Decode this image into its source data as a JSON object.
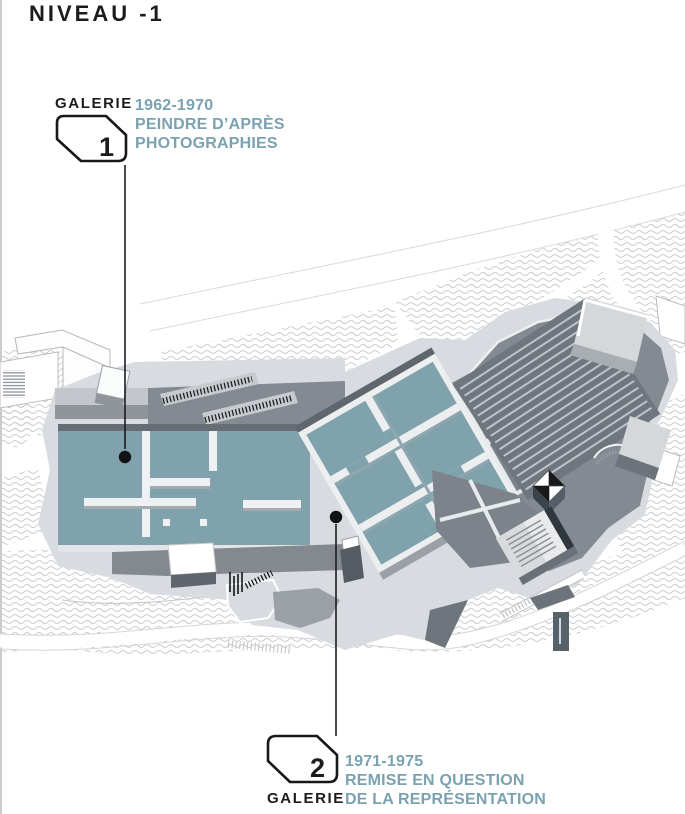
{
  "title": "NIVEAU -1",
  "galleries": [
    {
      "label": "GALERIE",
      "number": "1",
      "years": "1962-1970",
      "line1": "PEINDRE D’APRÈS",
      "line2": "PHOTOGRAPHIES"
    },
    {
      "label": "GALERIE",
      "number": "2",
      "years": "1971-1975",
      "line1": "REMISE EN QUESTION",
      "line2": "DE LA REPRÉSENTATION"
    }
  ],
  "colors": {
    "room_teal": "#7fa2ac",
    "accent_text": "#7aa2b0",
    "dark_area": "#7d838a",
    "circulation": "#848a91",
    "platform": "#d8dbdf",
    "ink": "#1b1c1e"
  }
}
